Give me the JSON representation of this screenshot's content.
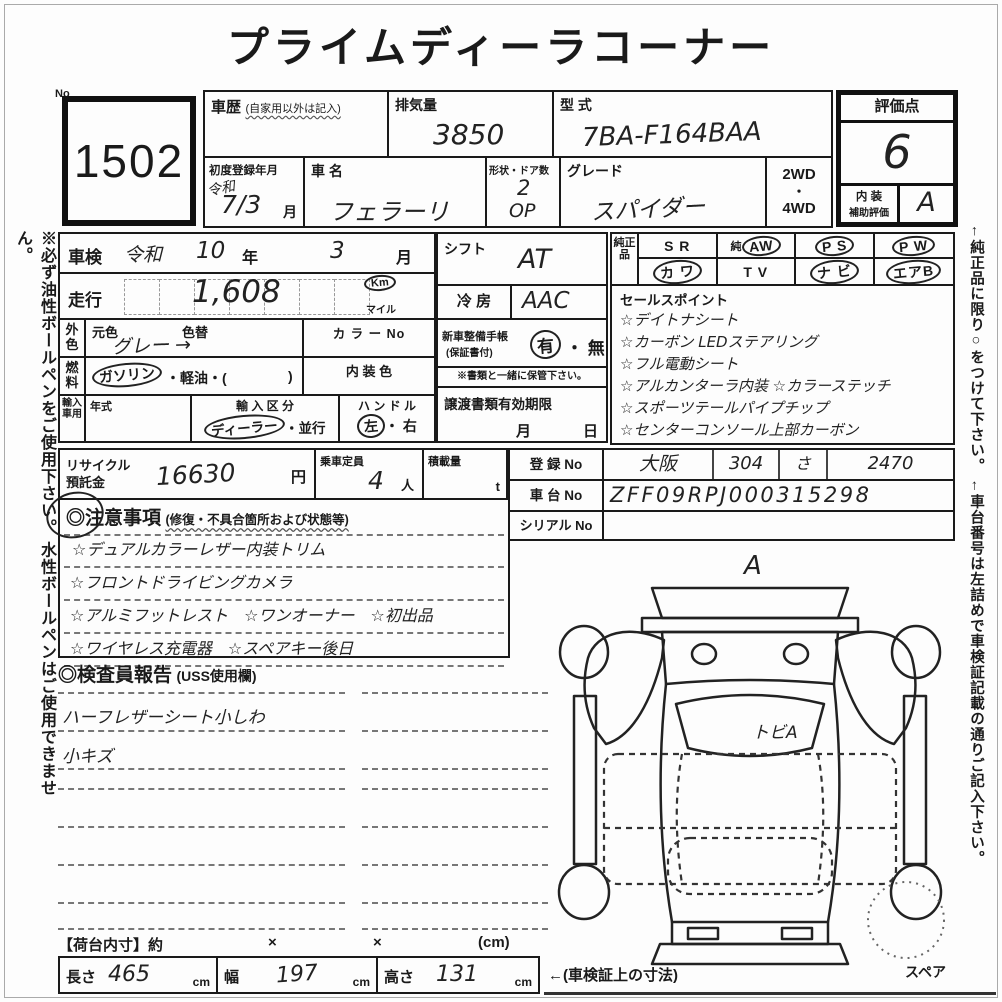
{
  "page": {
    "title": "プライムディーラコーナー",
    "lot_no_label": "No",
    "lot_number": "1502",
    "left_note": "※必ず油性ボールペンをご使用下さい。 水性ボールペンはご使用できません。",
    "right_note": "←純正品に限り○をつけて下さい。 ←車台番号は左詰めで車検証記載の通りご記入下さい。"
  },
  "header": {
    "history_label": "車歴",
    "history_note": "(自家用以外は記入)",
    "displacement_label": "排気量",
    "displacement_value": "3850",
    "model_label": "型 式",
    "model_value": "7BA-F164BAA",
    "first_reg_label": "初度登録年月",
    "first_reg_era": "令和",
    "first_reg_value": "7/3",
    "first_reg_unit": "月",
    "name_label": "車 名",
    "name_value": "フェラーリ",
    "shape_label": "形状・ドア数",
    "shape_value1": "2",
    "shape_value2": "OP",
    "grade_label": "グレード",
    "grade_value": "スパイダー",
    "drive_top": "2WD",
    "drive_dot": "・",
    "drive_bottom": "4WD"
  },
  "score": {
    "label": "評価点",
    "value": "6",
    "interior_label1": "内 装",
    "interior_label2": "補助評価",
    "interior_value": "A"
  },
  "inspection": {
    "label": "車検",
    "era": "令和",
    "year": "10",
    "year_unit": "年",
    "month": "3",
    "month_unit": "月"
  },
  "mileage": {
    "label": "走行",
    "value": "1,608",
    "unit_km": "Km",
    "unit_mile": "マイル",
    "unit_selected": "Km"
  },
  "exterior_color": {
    "label": "外色",
    "base_label": "元色",
    "change_label": "色替",
    "value": "グレー →",
    "color_no_label": "カ ラ ー No"
  },
  "fuel": {
    "label": "燃料",
    "gasoline": "ガソリン",
    "rest": "・軽油・(",
    "close_paren": ")",
    "selected": "ガソリン",
    "interior_color_label": "内 装 色"
  },
  "import_car": {
    "label": "輸入車用",
    "year_label": "年式",
    "division_label": "輸 入 区 分",
    "dealer": "ディーラー",
    "parallel": "・並行",
    "division_selected": "ディーラー",
    "handle_label": "ハ ン ド ル",
    "handle_left": "左",
    "handle_right": "・ 右",
    "handle_selected": "左"
  },
  "shift": {
    "label": "シフト",
    "value": "AT"
  },
  "aircon": {
    "label": "冷 房",
    "value": "AAC"
  },
  "service_book": {
    "label1": "新車整備手帳",
    "label2": "(保証書付)",
    "yes": "有",
    "no": "・ 無",
    "selected": "有",
    "keep_note": "※書類と一緒に保管下さい。"
  },
  "transfer_docs": {
    "label": "譲渡書類有効期限",
    "month": "月",
    "day": "日"
  },
  "genuine_parts": {
    "label": "純正品",
    "row1": [
      {
        "prefix": "",
        "text": "S R",
        "circled": false
      },
      {
        "prefix": "純",
        "text": "AW",
        "circled": true
      },
      {
        "prefix": "",
        "text": "P S",
        "circled": true
      },
      {
        "prefix": "",
        "text": "P W",
        "circled": true
      }
    ],
    "row2": [
      {
        "prefix": "",
        "text": "カ ワ",
        "circled": true
      },
      {
        "prefix": "",
        "text": "T V",
        "circled": false
      },
      {
        "prefix": "",
        "text": "ナ ビ",
        "circled": true
      },
      {
        "prefix": "",
        "text": "エアB",
        "circled": true
      }
    ]
  },
  "sales_points": {
    "title": "セールスポイント",
    "items": [
      "☆デイトナシート",
      "☆カーボン LEDステアリング",
      "☆フル電動シート",
      "☆アルカンターラ内装 ☆カラーステッチ",
      "☆スポーツテールパイプチップ",
      "☆センターコンソール上部カーボン"
    ]
  },
  "recycle": {
    "label1": "リサイクル",
    "label2": "預託金",
    "value": "16630",
    "unit": "円"
  },
  "capacity": {
    "label": "乗車定員",
    "value": "4",
    "unit": "人"
  },
  "load": {
    "label": "積載量",
    "unit": "t"
  },
  "registration": {
    "reg_label": "登 録 No",
    "reg_area": "大阪",
    "reg_class": "304",
    "reg_kana": "さ",
    "reg_number": "2470",
    "chassis_label": "車 台 No",
    "chassis_value": "ZFF09RPJ000315298",
    "serial_label": "シリアル No",
    "serial_value": ""
  },
  "cautions": {
    "title": "◎注意事項",
    "subtitle": "(修復・不具合箇所および状態等)",
    "lines": [
      "☆デュアルカラーレザー内装トリム",
      "☆フロントドライビングカメラ",
      "☆アルミフットレスト　☆ワンオーナー　☆初出品",
      "☆ワイヤレス充電器　☆スペアキー後日"
    ]
  },
  "inspector_report": {
    "title": "◎検査員報告",
    "subtitle": "(USS使用欄)",
    "lines": [
      "ハーフレザーシート小しわ",
      "小キズ"
    ]
  },
  "diagram": {
    "top_mark": "A",
    "windshield_note": "トビA",
    "spare_label": "スペア"
  },
  "dimensions": {
    "header_label": "【荷台内寸】約",
    "times1": "×",
    "times2": "×",
    "unit_note": "(cm)",
    "length_label": "長さ",
    "length_value": "465",
    "length_unit": "cm",
    "width_label": "幅",
    "width_value": "197",
    "width_unit": "cm",
    "height_label": "高さ",
    "height_value": "131",
    "height_unit": "cm",
    "note": "←(車検証上の寸法)"
  }
}
